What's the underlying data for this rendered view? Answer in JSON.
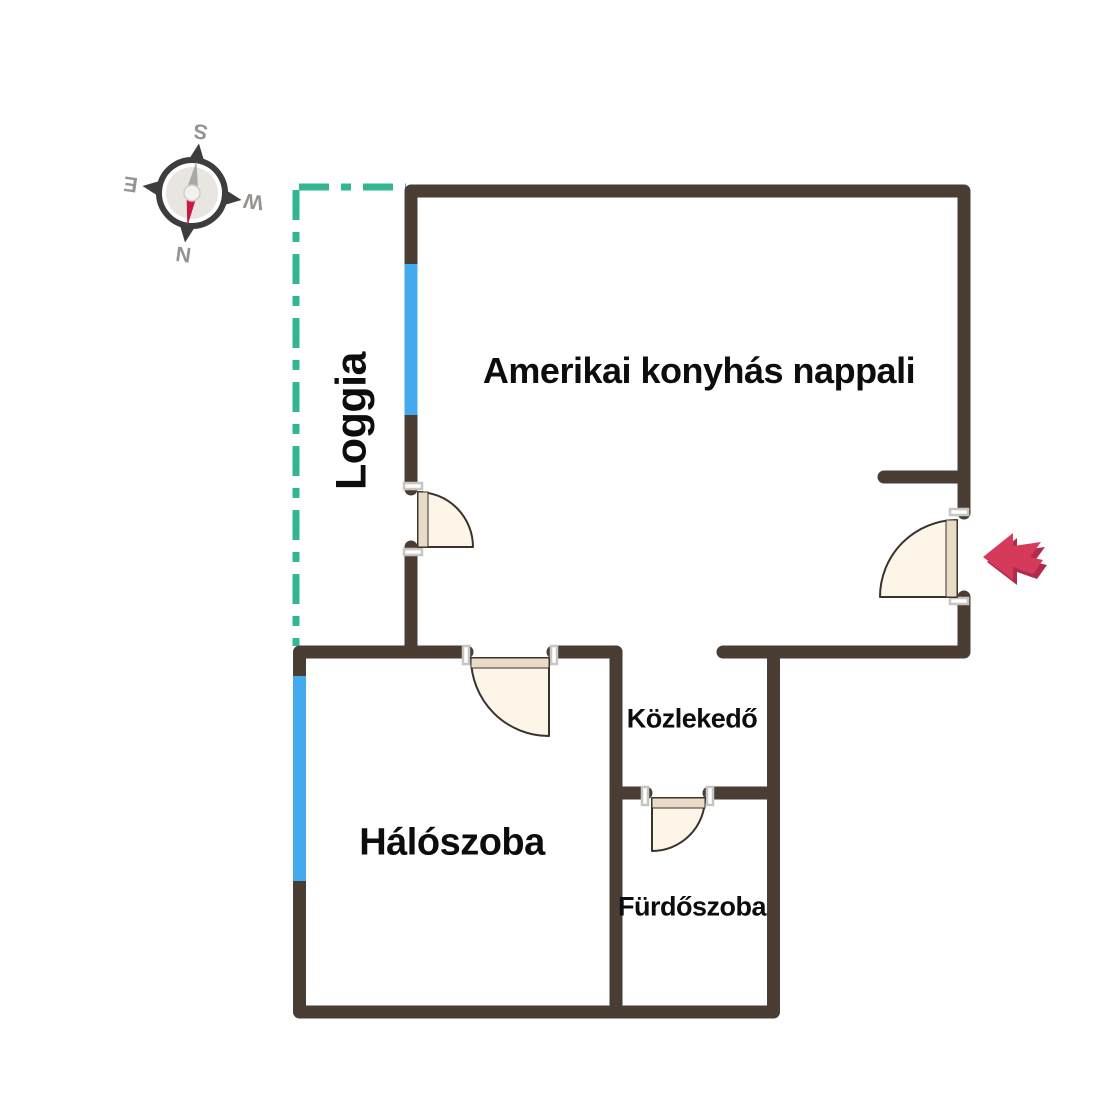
{
  "rooms": {
    "living": {
      "label": "Amerikai konyhás nappali"
    },
    "loggia": {
      "label": "Loggia"
    },
    "bedroom": {
      "label": "Hálószoba"
    },
    "hall": {
      "label": "Közlekedő"
    },
    "bathroom": {
      "label": "Fürdőszoba"
    }
  },
  "compass": {
    "points": {
      "s": "S",
      "w": "W",
      "n": "N",
      "e": "E"
    }
  },
  "colors": {
    "bg": "#ffffff",
    "wall": "#4a3e34",
    "window": "#45aaed",
    "dash": "#33b793",
    "door-fill": "#fcf5e8",
    "door-stroke": "#3a332c",
    "door-leaf": "#e8dcc6",
    "jamb": "#c8c6c2",
    "arrow": "#d63a5b",
    "arrow-shadow": "#b02c4c",
    "needle-red": "#c91a45",
    "needle-gray": "#a8a8a8",
    "compass-ring": "#3d3d3d",
    "compass-inner": "#e9e6e2",
    "compass-letter": "#969390",
    "label": "#0d0d0d"
  }
}
